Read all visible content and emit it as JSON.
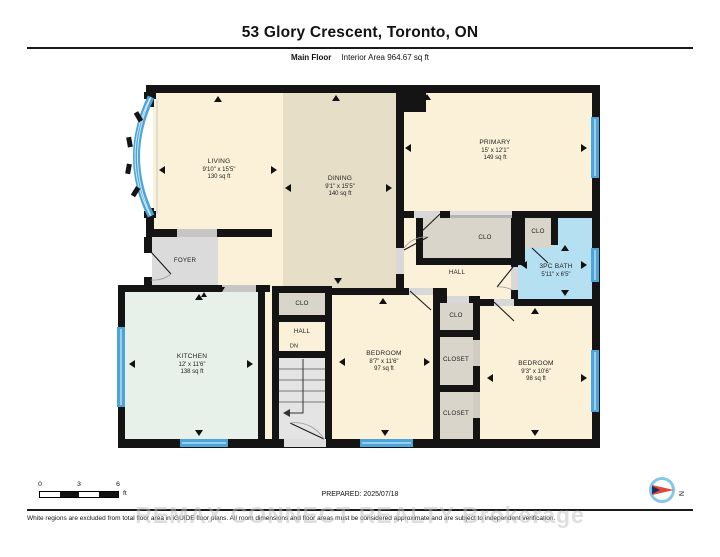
{
  "header": {
    "title": "53 Glory Crescent, Toronto, ON",
    "floor_label": "Main Floor",
    "area_label": "Interior Area 964.67 sq ft"
  },
  "rooms": [
    {
      "name": "LIVING",
      "dims": "9'10\" x 15'5\"",
      "area": "130 sq ft"
    },
    {
      "name": "DINING",
      "dims": "9'1\" x 15'5\"",
      "area": "140 sq ft"
    },
    {
      "name": "PRIMARY",
      "dims": "15' x 12'1\"",
      "area": "149 sq ft"
    },
    {
      "name": "FOYER"
    },
    {
      "name": "KITCHEN",
      "dims": "12' x 11'6\"",
      "area": "138 sq ft"
    },
    {
      "name": "CLO"
    },
    {
      "name": "HALL"
    },
    {
      "name": "DN"
    },
    {
      "name": "BEDROOM",
      "dims": "8'7\" x 11'6\"",
      "area": "97 sq ft"
    },
    {
      "name": "CLO"
    },
    {
      "name": "CLO"
    },
    {
      "name": "HALL"
    },
    {
      "name": "3PC BATH",
      "dims": "5'11\" x 6'5\""
    },
    {
      "name": "CLO"
    },
    {
      "name": "CLOSET"
    },
    {
      "name": "CLOSET"
    },
    {
      "name": "BEDROOM",
      "dims": "9'3\" x 10'6\"",
      "area": "98 sq ft"
    }
  ],
  "footer": {
    "scale_ticks": [
      "0",
      "3",
      "6"
    ],
    "scale_unit": "ft",
    "prepared": "PREPARED: 2025/07/18",
    "disclaimer": "White regions are excluded from total floor area in iGUIDE floor plans. All room dimensions and floor areas must be considered approximate and are subject to independent verification.",
    "watermark": "REMAX CONNECT REALTY  Brokerage",
    "compass_north": "N"
  },
  "colors": {
    "wall": "#141414",
    "floor_cream": "#FAF1D8",
    "dining_tan": "#E7DEC8",
    "foyer_gray": "#DBDBDB",
    "closet_gray": "#DAD5CA",
    "kitchen_mint": "#E7F0E9",
    "bath_blue": "#B5E0F2",
    "window_blue": "#4BA5D9",
    "stairs_gray": "#E4E4E4"
  }
}
